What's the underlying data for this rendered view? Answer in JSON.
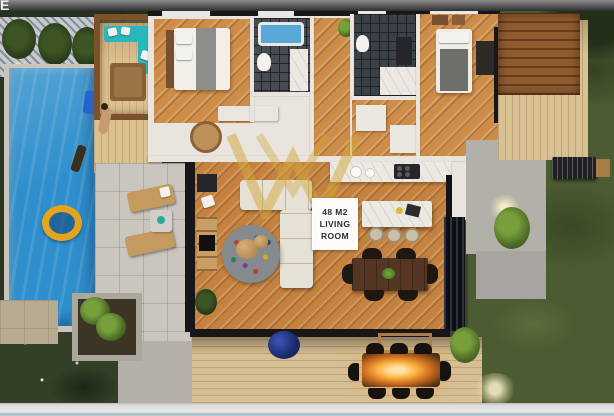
{
  "frame": {
    "corner_letter": "E"
  },
  "room_label": {
    "line1": "48 M2",
    "line2": "LIVING",
    "line3": "ROOM"
  },
  "watermark": {
    "shape": "double-W-monogram",
    "color": "#d2a83e"
  },
  "colors": {
    "pool_blue": "#2f8fcc",
    "interior_wood": "#c5823f",
    "outdoor_deck": "#d5bf93",
    "lawn_green": "#4c5b31",
    "watermark_gold": "#d2a83e",
    "label_text": "#2e2e2e",
    "top_bar": "#5a5a5a",
    "bottom_bar": "#dcdcdc",
    "outdoor_sofa_teal": "#27b7bc",
    "fire_glow": "#ffb244"
  }
}
